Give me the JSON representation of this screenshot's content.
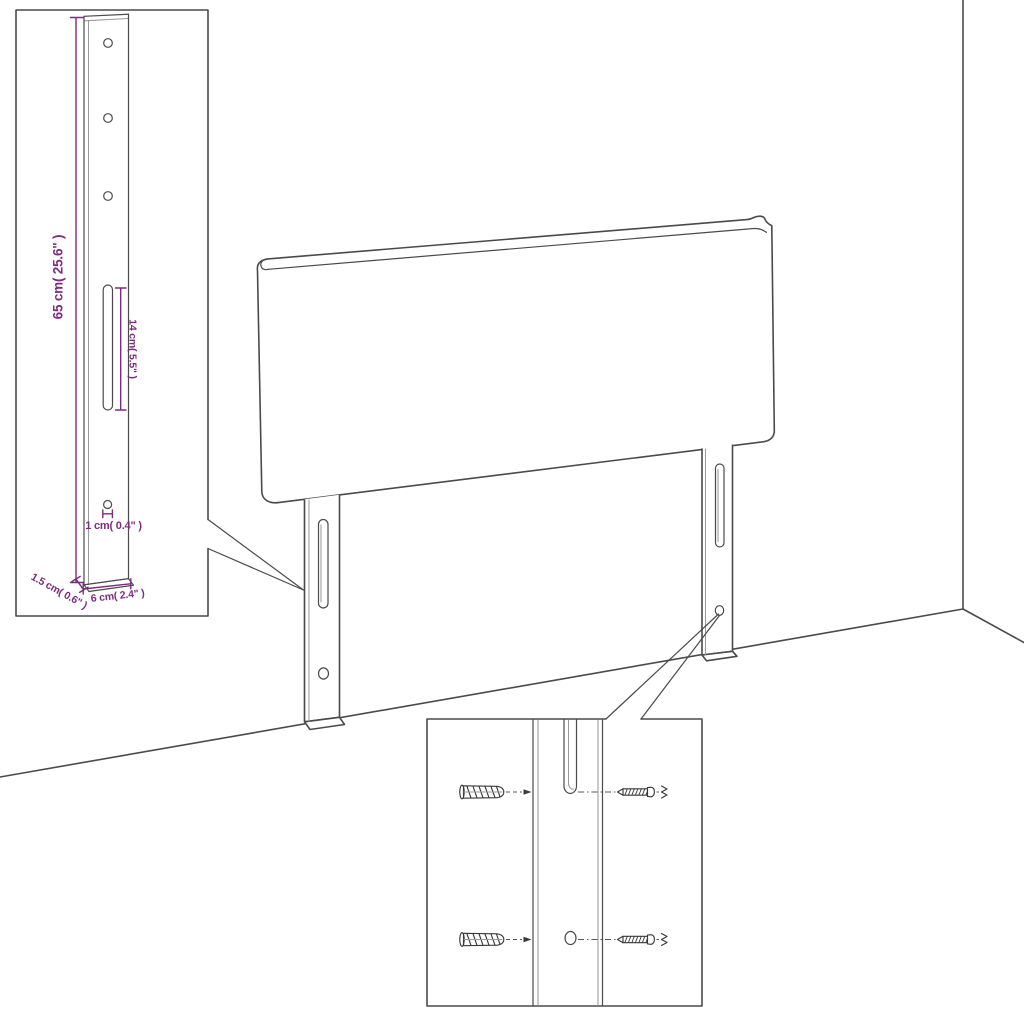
{
  "colors": {
    "background": "#ffffff",
    "outline": "#4a4a4a",
    "outline_light": "#9a9a9a",
    "dimension": "#7c2b7e"
  },
  "leg_detail_inset": {
    "dim_height_label": "65 cm( 25.6\" )",
    "dim_slot_label": "14 cm( 5.5\" )",
    "dim_hole_label": "1 cm( 0.4\" )",
    "dim_thickness_label": "1.5 cm( 0.6\" )",
    "dim_width_label": "6 cm( 2.4\" )"
  },
  "mounting_inset": {
    "hardware_icons": [
      "wall-plug-icon",
      "screw-icon",
      "wall-plug-icon",
      "screw-icon"
    ]
  }
}
